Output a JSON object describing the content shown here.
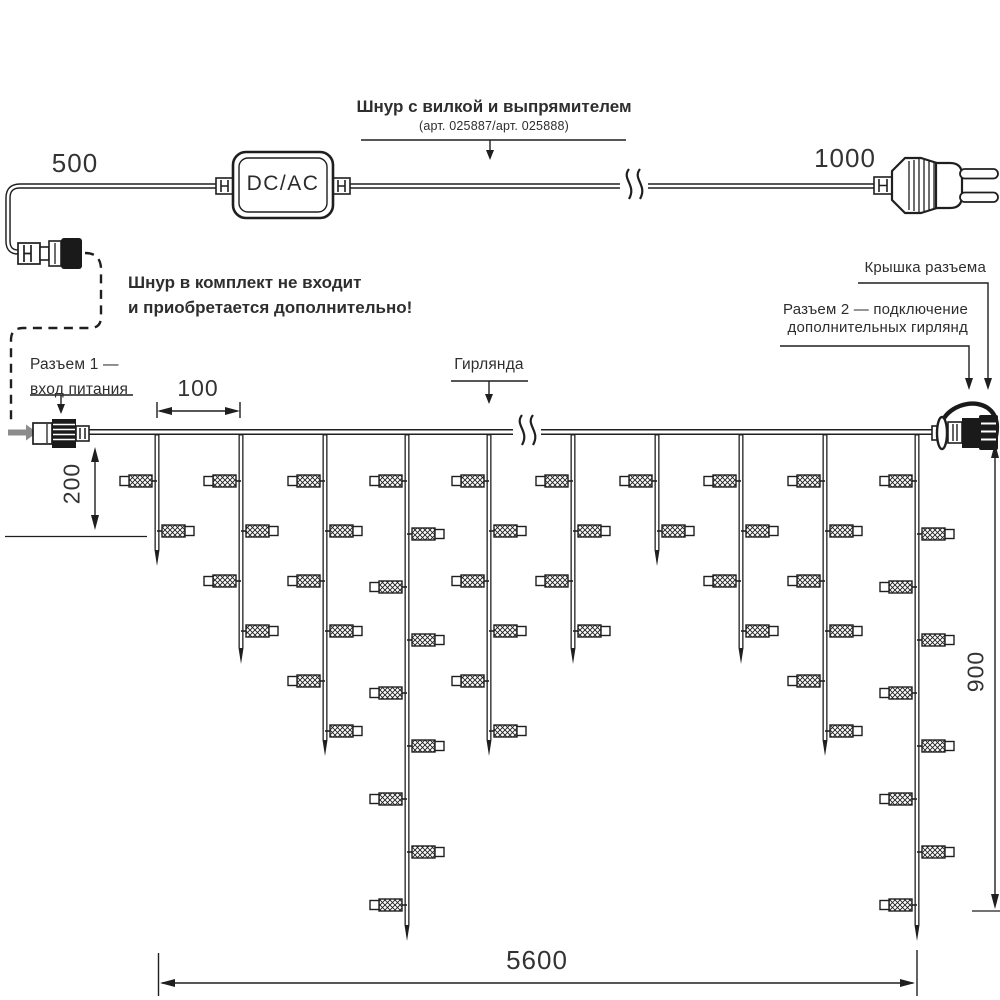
{
  "colors": {
    "line": "#1f1f1f",
    "text": "#2e2e2e",
    "gray_arrow": "#8c8c8c",
    "background": "#ffffff"
  },
  "power_cord": {
    "label": "Шнур с вилкой и выпрямителем",
    "article_note": "(арт. 025887/арт. 025888)",
    "converter": "DC/AC",
    "left_length": "500",
    "plug_length": "1000"
  },
  "note": {
    "line1": "Шнур в комплект не входит",
    "line2": "и приобретается дополнительно!"
  },
  "connector1": {
    "line1": "Разъем 1 —",
    "line2": "вход питания"
  },
  "connector2": {
    "line1": "Разъем 2 — подключение",
    "line2": "дополнительных гирлянд"
  },
  "cap_label": "Крышка разъема",
  "garland_label": "Гирлянда",
  "dimensions": {
    "drop_spacing": "100",
    "first_drop": "200",
    "side_height": "900",
    "total_width": "5600"
  },
  "garland": {
    "wire_y": 432,
    "x_start": 88,
    "x_end": 935,
    "lamp_y0": 481,
    "lamp_spacing": 50,
    "lamp_spacing_long": 53,
    "drops": [
      {
        "x": 157,
        "lamps": 2,
        "tip": 566
      },
      {
        "x": 241,
        "lamps": 4,
        "tip": 664
      },
      {
        "x": 325,
        "lamps": 6,
        "tip": 756
      },
      {
        "x": 407,
        "lamps": 9,
        "tip": 941
      },
      {
        "x": 489,
        "lamps": 6,
        "tip": 756
      },
      {
        "x": 573,
        "lamps": 4,
        "tip": 664
      },
      {
        "x": 657,
        "lamps": 2,
        "tip": 566
      },
      {
        "x": 741,
        "lamps": 4,
        "tip": 664
      },
      {
        "x": 825,
        "lamps": 6,
        "tip": 756
      },
      {
        "x": 917,
        "lamps": 9,
        "tip": 941
      }
    ]
  }
}
